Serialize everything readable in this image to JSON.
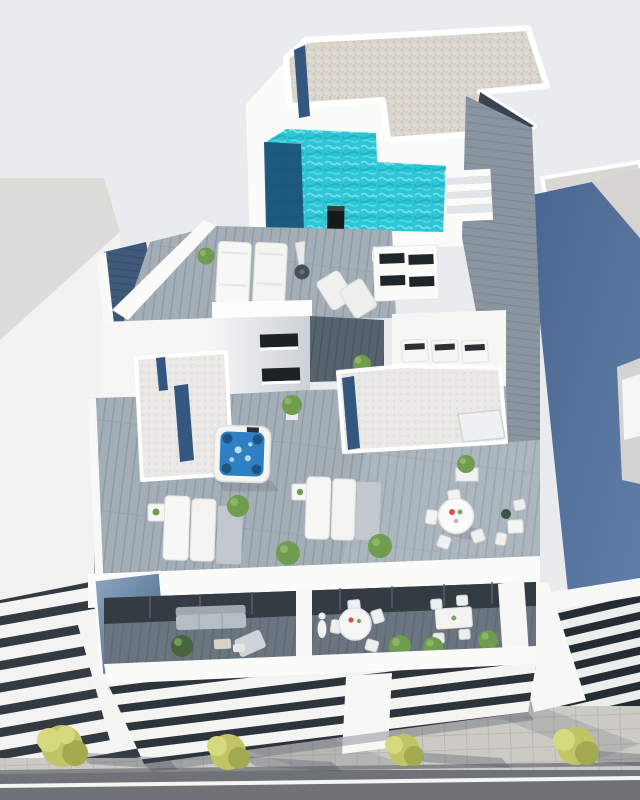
{
  "scene": {
    "type": "architectural-3d-render",
    "description": "Aerial bird's-eye 3D rendering of a modern white apartment building: rooftop gravel roof, turquoise L-shaped swimming pool with steps and outdoor shower, plank solarium decks with sun loungers and parasol, stairwell volume, white-gravel roofs with blue glass balustrades, hot tub terrace with dining sets, recessed balconies with lounge and dining furniture, louvered lower facade, neighbouring buildings either side, sidewalk with trees and a road at the bottom",
    "objects": [
      "sky",
      "left-neighbor-building",
      "right-neighbor-building",
      "blue-shaded-wall",
      "gravel-roof",
      "glass-balustrade",
      "roof-stair-void",
      "pool",
      "pool-deep-end",
      "pool-steps",
      "outdoor-shower",
      "plank-walkway",
      "solarium-deck",
      "sun-loungers",
      "folded-parasol",
      "deck-chairs",
      "topiary",
      "louvered-plant-box",
      "ac-units",
      "stairwell",
      "hot-tub",
      "terrace-deck",
      "side-tables",
      "round-dining-table",
      "dining-chairs",
      "small-bistro-set",
      "planters",
      "bushes",
      "parapet",
      "glass-corner-balcony",
      "balcony-sofa",
      "balcony-chaise",
      "balcony-round-table",
      "balcony-rect-table",
      "balcony-plants",
      "louvered-facade",
      "facade-pier",
      "sidewalk",
      "pavers",
      "street-trees",
      "tree-shadows",
      "road",
      "road-marking"
    ]
  },
  "colors": {
    "sky": "#e9ebee",
    "white": "#fbfbfa",
    "whiteSoft": "#f1f2f2",
    "shade": "#dfe2e6",
    "roofGray": "#d8d7d3",
    "gravel": "#d9d5cc",
    "gravelDot": "#c6c1b5",
    "gravelWhite": "#e9e8e5",
    "gravelWhiteDot": "#d6d5d1",
    "pool": "#2ec5d6",
    "poolLight": "#7fe6ec",
    "poolMid": "#17aabd",
    "poolDeep": "#1c4e76",
    "deck": "#a3aeb7",
    "deckLine": "#8f9ca6",
    "deckFloor": "#6a7580",
    "deckFloorLine": "#5d6873",
    "deckDark": "#57636f",
    "deckDarkLine": "#4a5561",
    "walk": "#8b95a0",
    "walkLine": "#7b8793",
    "navyDeck": "#41597a",
    "navyDeckLine": "#374e6c",
    "glass": "#33577e",
    "glassLight": "#8fa8c4",
    "hotTub": "#2f80c2",
    "hotTubFoam": "#cfe7f5",
    "hotTubSeat": "#174a77",
    "blueWall": "#4a6690",
    "blueWall2": "#607ea8",
    "road": "#6f7377",
    "roadLine": "#f5f5f3",
    "sidewalk": "#cbcac5",
    "paver": "#b8b7b1",
    "tree": "#c2c566",
    "treeLight": "#d6da7e",
    "treeDark": "#a3a94e",
    "slot": "#20252a",
    "sofa": "#b6bec5",
    "plant": "#6f9c4e",
    "plantDark": "#49633c",
    "shadow": "rgba(70,78,92,0.32)",
    "shadowSoft": "rgba(85,92,105,0.18)"
  }
}
